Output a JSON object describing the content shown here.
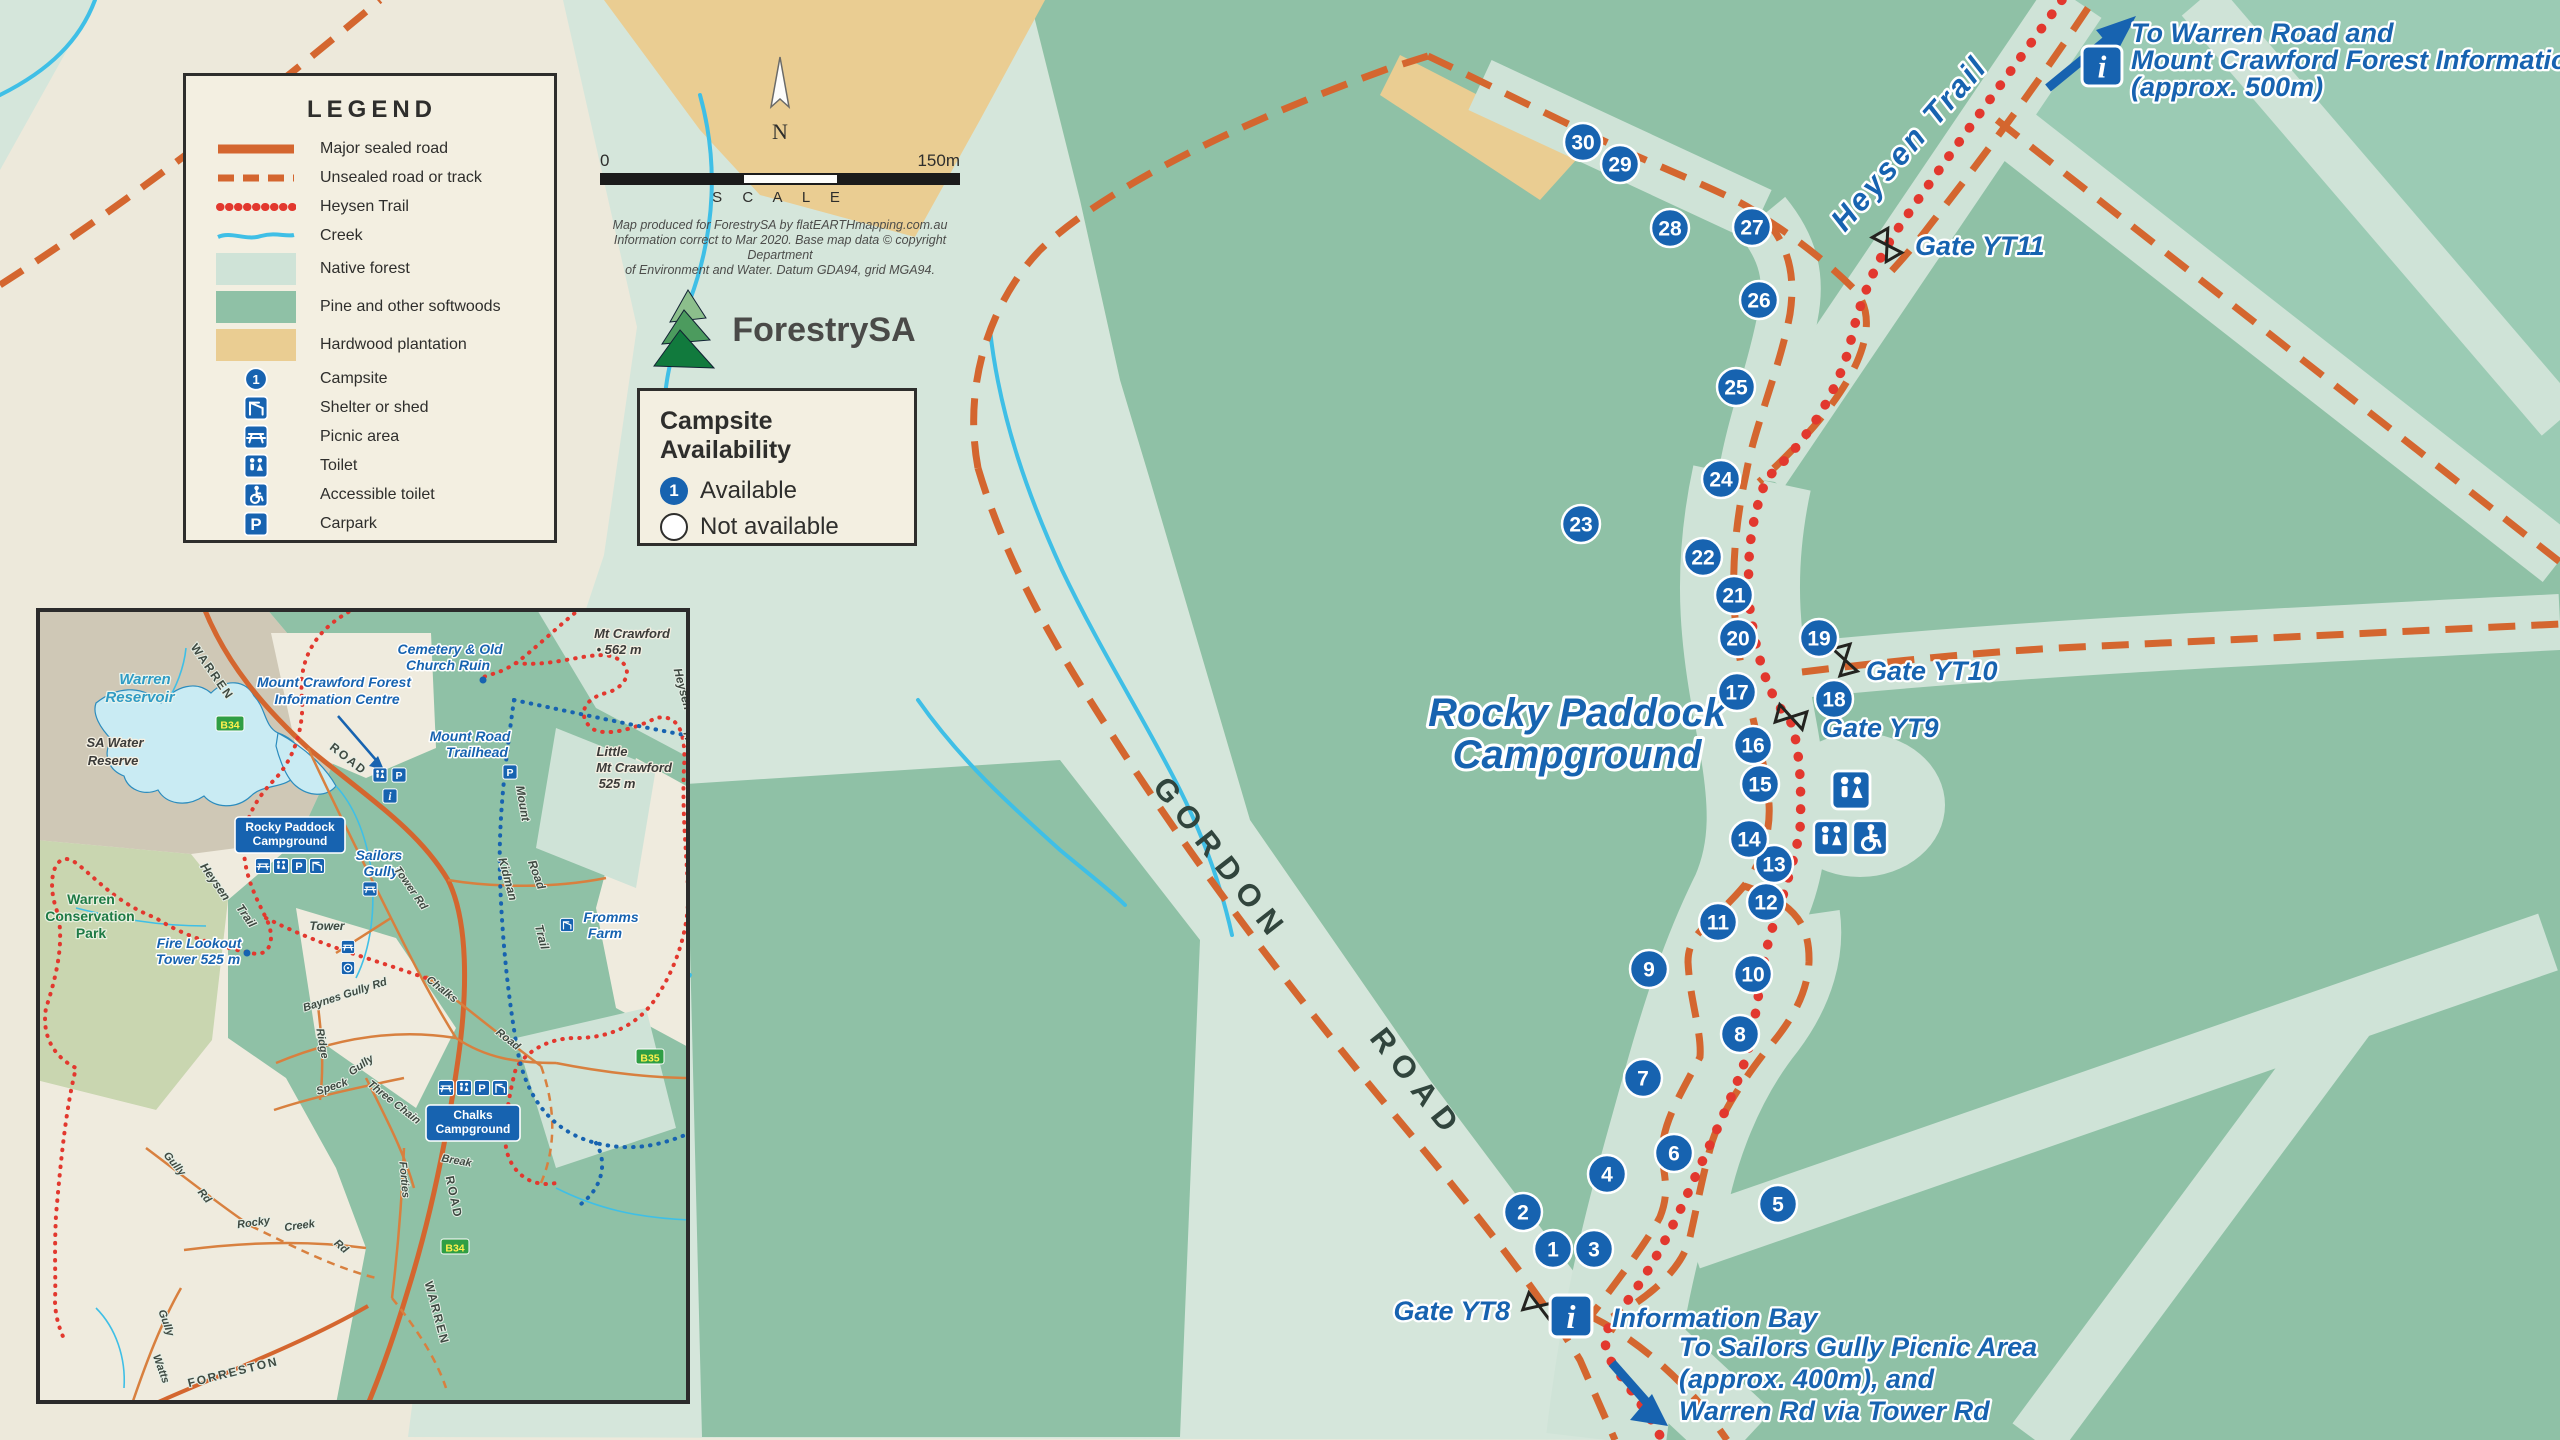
{
  "legend": {
    "title": "LEGEND",
    "line_items": [
      {
        "key": "road-solid",
        "label": "Major sealed road"
      },
      {
        "key": "road-dashed",
        "label": "Unsealed road or track"
      },
      {
        "key": "trail-dots",
        "label": "Heysen Trail"
      },
      {
        "key": "creek",
        "label": "Creek"
      }
    ],
    "area_items": [
      {
        "key": "native",
        "label": "Native forest",
        "color": "#CFE3D7"
      },
      {
        "key": "pine",
        "label": "Pine and other softwoods",
        "color": "#8FC1A6"
      },
      {
        "key": "hardwood",
        "label": "Hardwood plantation",
        "color": "#EACD92"
      }
    ],
    "icon_items": [
      {
        "key": "campsite",
        "label": "Campsite"
      },
      {
        "key": "shelter",
        "label": "Shelter or shed"
      },
      {
        "key": "picnic",
        "label": "Picnic area"
      },
      {
        "key": "toilet",
        "label": "Toilet"
      },
      {
        "key": "accessible",
        "label": "Accessible toilet"
      },
      {
        "key": "carpark",
        "label": "Carpark"
      }
    ]
  },
  "scalebar": {
    "start": "0",
    "end": "150m",
    "label": "S C A L E",
    "north": "N"
  },
  "credits": [
    "Map produced for ForestrySA by flatEARTHmapping.com.au",
    "Information correct to Mar 2020. Base map data © copyright Department",
    "of Environment and Water. Datum GDA94, grid MGA94."
  ],
  "logo": {
    "name": "ForestrySA"
  },
  "availability": {
    "title": "Campsite Availability",
    "available_number": "1",
    "available_label": "Available",
    "not_available_label": "Not available"
  },
  "colors": {
    "accent_blue": "#1763B0",
    "road_orange": "#D4662F",
    "trail_red": "#E2382E",
    "creek_blue": "#3FBFE6",
    "cream": "#EDE9DB",
    "pale_green": "#CFE3D7",
    "medium_green": "#8FC1A6",
    "hardwood_tan": "#EACD92"
  },
  "map": {
    "campsites": [
      {
        "n": "1",
        "x": 1553,
        "y": 1249
      },
      {
        "n": "2",
        "x": 1523,
        "y": 1212
      },
      {
        "n": "3",
        "x": 1594,
        "y": 1249
      },
      {
        "n": "4",
        "x": 1607,
        "y": 1174
      },
      {
        "n": "5",
        "x": 1778,
        "y": 1204
      },
      {
        "n": "6",
        "x": 1674,
        "y": 1153
      },
      {
        "n": "7",
        "x": 1643,
        "y": 1078
      },
      {
        "n": "8",
        "x": 1740,
        "y": 1034
      },
      {
        "n": "9",
        "x": 1649,
        "y": 969
      },
      {
        "n": "10",
        "x": 1753,
        "y": 974
      },
      {
        "n": "11",
        "x": 1718,
        "y": 922
      },
      {
        "n": "12",
        "x": 1766,
        "y": 902
      },
      {
        "n": "13",
        "x": 1774,
        "y": 864
      },
      {
        "n": "14",
        "x": 1749,
        "y": 839
      },
      {
        "n": "15",
        "x": 1760,
        "y": 784
      },
      {
        "n": "16",
        "x": 1753,
        "y": 745
      },
      {
        "n": "17",
        "x": 1737,
        "y": 692
      },
      {
        "n": "18",
        "x": 1834,
        "y": 699
      },
      {
        "n": "19",
        "x": 1819,
        "y": 638
      },
      {
        "n": "20",
        "x": 1738,
        "y": 638
      },
      {
        "n": "21",
        "x": 1734,
        "y": 595
      },
      {
        "n": "22",
        "x": 1703,
        "y": 557
      },
      {
        "n": "23",
        "x": 1581,
        "y": 524
      },
      {
        "n": "24",
        "x": 1721,
        "y": 479
      },
      {
        "n": "25",
        "x": 1736,
        "y": 387
      },
      {
        "n": "26",
        "x": 1759,
        "y": 300
      },
      {
        "n": "27",
        "x": 1752,
        "y": 227
      },
      {
        "n": "28",
        "x": 1670,
        "y": 228
      },
      {
        "n": "29",
        "x": 1620,
        "y": 164
      },
      {
        "n": "30",
        "x": 1583,
        "y": 142
      }
    ],
    "gates": [
      {
        "x": 1539,
        "y": 1306,
        "r": 20
      },
      {
        "x": 1791,
        "y": 717,
        "r": 15
      },
      {
        "x": 1845,
        "y": 660,
        "r": 75
      },
      {
        "x": 1887,
        "y": 245,
        "r": 60
      }
    ],
    "facilities": [
      {
        "t": "toilet",
        "x": 1851,
        "y": 790,
        "s": 40
      },
      {
        "t": "toilet",
        "x": 1831,
        "y": 838,
        "s": 36
      },
      {
        "t": "accessible",
        "x": 1870,
        "y": 838,
        "s": 36
      },
      {
        "t": "info",
        "x": 1571,
        "y": 1316,
        "s": 44
      },
      {
        "t": "info",
        "x": 2102,
        "y": 66,
        "s": 42
      }
    ],
    "labels": [
      {
        "t": "Rocky Paddock",
        "x": 1577,
        "y": 726,
        "r": 0,
        "c": "t-big"
      },
      {
        "t": "Campground",
        "x": 1577,
        "y": 768,
        "r": 0,
        "c": "t-big"
      },
      {
        "t": "Heysen  Trail",
        "x": 1917,
        "y": 150,
        "r": -49,
        "c": "t-trail"
      },
      {
        "t": "GORDON",
        "x": 1213,
        "y": 866,
        "r": 52,
        "c": "t-road"
      },
      {
        "t": "ROAD",
        "x": 1409,
        "y": 1090,
        "r": 52,
        "c": "t-road"
      },
      {
        "t": "Gate YT8",
        "x": 1510,
        "y": 1320,
        "r": 0,
        "c": "t-gate t-gate-end"
      },
      {
        "t": "Gate YT9",
        "x": 1822,
        "y": 737,
        "r": 0,
        "c": "t-gate"
      },
      {
        "t": "Gate YT10",
        "x": 1866,
        "y": 680,
        "r": 0,
        "c": "t-gate"
      },
      {
        "t": "Gate YT11",
        "x": 1915,
        "y": 255,
        "r": 0,
        "c": "t-gate"
      },
      {
        "t": "Information Bay",
        "x": 1612,
        "y": 1327,
        "r": 0,
        "c": "t-gate"
      },
      {
        "t": "To Warren Road and",
        "x": 2131,
        "y": 42,
        "r": 0,
        "c": "t-note"
      },
      {
        "t": "Mount Crawford Forest Information Centre",
        "x": 2131,
        "y": 69,
        "r": 0,
        "c": "t-note"
      },
      {
        "t": "(approx. 500m)",
        "x": 2131,
        "y": 96,
        "r": 0,
        "c": "t-note"
      },
      {
        "t": "To Sailors Gully Picnic Area",
        "x": 1679,
        "y": 1356,
        "r": 0,
        "c": "t-note"
      },
      {
        "t": "(approx. 400m), and",
        "x": 1679,
        "y": 1388,
        "r": 0,
        "c": "t-note"
      },
      {
        "t": "Warren Rd via Tower Rd",
        "x": 1679,
        "y": 1420,
        "r": 0,
        "c": "t-note"
      }
    ]
  },
  "inset": {
    "labels": [
      {
        "t": "Warren",
        "x": 109,
        "y": 76,
        "r": 0,
        "c": "i-water"
      },
      {
        "t": "Reservoir",
        "x": 104,
        "y": 94,
        "r": 0,
        "c": "i-water"
      },
      {
        "t": "WARREN",
        "x": 173,
        "y": 66,
        "r": 55,
        "c": "i-caps"
      },
      {
        "t": "ROAD",
        "x": 310,
        "y": 154,
        "r": 38,
        "c": "i-caps"
      },
      {
        "t": "SA Water",
        "x": 79,
        "y": 139,
        "r": 0,
        "c": "i-dark"
      },
      {
        "t": "Reserve",
        "x": 77,
        "y": 157,
        "r": 0,
        "c": "i-dark"
      },
      {
        "t": "Mount Crawford Forest",
        "x": 298,
        "y": 79,
        "r": 0,
        "c": "i-blue"
      },
      {
        "t": "Information Centre",
        "x": 301,
        "y": 96,
        "r": 0,
        "c": "i-blue"
      },
      {
        "t": "Cemetery & Old",
        "x": 414,
        "y": 46,
        "r": 0,
        "c": "i-blue"
      },
      {
        "t": "Church Ruin",
        "x": 412,
        "y": 62,
        "r": 0,
        "c": "i-blue"
      },
      {
        "t": "Mt Crawford",
        "x": 596,
        "y": 30,
        "r": 0,
        "c": "i-dark"
      },
      {
        "t": "• 562 m",
        "x": 583,
        "y": 46,
        "r": 0,
        "c": "i-dark"
      },
      {
        "t": "Mount Road",
        "x": 434,
        "y": 133,
        "r": 0,
        "c": "i-blue"
      },
      {
        "t": "Trailhead",
        "x": 441,
        "y": 149,
        "r": 0,
        "c": "i-blue"
      },
      {
        "t": "Little",
        "x": 576,
        "y": 148,
        "r": 0,
        "c": "i-dark"
      },
      {
        "t": "Mt Crawford",
        "x": 598,
        "y": 164,
        "r": 0,
        "c": "i-dark"
      },
      {
        "t": "525 m",
        "x": 581,
        "y": 180,
        "r": 0,
        "c": "i-dark"
      },
      {
        "t": "Mount",
        "x": 483,
        "y": 196,
        "r": 80,
        "c": "i-road"
      },
      {
        "t": "Road",
        "x": 497,
        "y": 268,
        "r": 70,
        "c": "i-road"
      },
      {
        "t": "Kidman",
        "x": 468,
        "y": 272,
        "r": 75,
        "c": "i-road"
      },
      {
        "t": "Trail",
        "x": 502,
        "y": 330,
        "r": 75,
        "c": "i-road"
      },
      {
        "t": "Heysen",
        "x": 643,
        "y": 82,
        "r": 75,
        "c": "i-road"
      },
      {
        "t": "Trail",
        "x": 650,
        "y": 135,
        "r": 75,
        "c": "i-road"
      },
      {
        "t": "Heysen",
        "x": 176,
        "y": 276,
        "r": 55,
        "c": "i-road"
      },
      {
        "t": "Trail",
        "x": 207,
        "y": 310,
        "r": 55,
        "c": "i-road"
      },
      {
        "t": "Sailors",
        "x": 343,
        "y": 252,
        "r": 0,
        "c": "i-blue"
      },
      {
        "t": "Gully",
        "x": 345,
        "y": 268,
        "r": 0,
        "c": "i-blue"
      },
      {
        "t": "Tower Rd",
        "x": 372,
        "y": 282,
        "r": 55,
        "c": "i-road-sm"
      },
      {
        "t": "Tower",
        "x": 291,
        "y": 322,
        "r": 0,
        "c": "i-road"
      },
      {
        "t": "Fire Lookout",
        "x": 163,
        "y": 340,
        "r": 0,
        "c": "i-blue"
      },
      {
        "t": "Tower 525 m",
        "x": 162,
        "y": 356,
        "r": 0,
        "c": "i-blue"
      },
      {
        "t": "Warren",
        "x": 55,
        "y": 296,
        "r": 0,
        "c": "i-green"
      },
      {
        "t": "Conservation",
        "x": 54,
        "y": 313,
        "r": 0,
        "c": "i-green"
      },
      {
        "t": "Park",
        "x": 55,
        "y": 330,
        "r": 0,
        "c": "i-green"
      },
      {
        "t": "Fromms",
        "x": 575,
        "y": 314,
        "r": 0,
        "c": "i-blue"
      },
      {
        "t": "Farm",
        "x": 569,
        "y": 330,
        "r": 0,
        "c": "i-blue"
      },
      {
        "t": "Baynes Gully Rd",
        "x": 310,
        "y": 390,
        "r": -18,
        "c": "i-road-sm"
      },
      {
        "t": "Ridge",
        "x": 283,
        "y": 436,
        "r": 80,
        "c": "i-road-sm"
      },
      {
        "t": "Gully",
        "x": 327,
        "y": 460,
        "r": -35,
        "c": "i-road-sm"
      },
      {
        "t": "Speck",
        "x": 297,
        "y": 482,
        "r": -18,
        "c": "i-road-sm"
      },
      {
        "t": "Three Chain",
        "x": 356,
        "y": 497,
        "r": 38,
        "c": "i-road-sm"
      },
      {
        "t": "Chalks",
        "x": 404,
        "y": 384,
        "r": 38,
        "c": "i-road-sm"
      },
      {
        "t": "Road",
        "x": 470,
        "y": 434,
        "r": 38,
        "c": "i-road-sm"
      },
      {
        "t": "Break",
        "x": 420,
        "y": 556,
        "r": 10,
        "c": "i-road-sm"
      },
      {
        "t": "Forties",
        "x": 365,
        "y": 572,
        "r": 85,
        "c": "i-road-sm"
      },
      {
        "t": "Gully",
        "x": 136,
        "y": 558,
        "r": 50,
        "c": "i-road-sm"
      },
      {
        "t": "Rd",
        "x": 166,
        "y": 590,
        "r": 50,
        "c": "i-road-sm"
      },
      {
        "t": "Rocky",
        "x": 218,
        "y": 618,
        "r": -8,
        "c": "i-road-sm"
      },
      {
        "t": "Creek",
        "x": 264,
        "y": 621,
        "r": -8,
        "c": "i-road-sm"
      },
      {
        "t": "Rd",
        "x": 303,
        "y": 641,
        "r": 40,
        "c": "i-road-sm"
      },
      {
        "t": "Gully",
        "x": 127,
        "y": 716,
        "r": 70,
        "c": "i-road-sm"
      },
      {
        "t": "Watts",
        "x": 122,
        "y": 762,
        "r": 70,
        "c": "i-road-sm"
      },
      {
        "t": "FORRESTON",
        "x": 198,
        "y": 768,
        "r": -14,
        "c": "i-caps"
      },
      {
        "t": "WARREN",
        "x": 397,
        "y": 706,
        "r": 75,
        "c": "i-caps"
      },
      {
        "t": "ROAD",
        "x": 414,
        "y": 590,
        "r": 78,
        "c": "i-caps"
      }
    ],
    "badges": [
      {
        "text": "B34",
        "x": 194,
        "y": 117
      },
      {
        "text": "B35",
        "x": 614,
        "y": 450
      },
      {
        "text": "B34",
        "x": 419,
        "y": 640
      }
    ],
    "campground_boxes": [
      {
        "lines": [
          "Rocky Paddock",
          "Campground"
        ],
        "x": 254,
        "y": 211,
        "w": 110,
        "icons": [
          "picnic",
          "toilet",
          "carpark",
          "shelter"
        ],
        "icons_y": 258
      },
      {
        "lines": [
          "Chalks",
          "Campground"
        ],
        "x": 437,
        "y": 499,
        "w": 94,
        "icons": [
          "picnic",
          "toilet",
          "carpark",
          "shelter"
        ],
        "icons_y": 480
      }
    ],
    "poi_icons": [
      {
        "t": "picnic",
        "x": 334,
        "y": 281,
        "s": 15
      },
      {
        "t": "picnic",
        "x": 312,
        "y": 339,
        "s": 14
      },
      {
        "t": "lookout",
        "x": 312,
        "y": 360,
        "s": 14
      },
      {
        "t": "toilet",
        "x": 344,
        "y": 167,
        "s": 15
      },
      {
        "t": "carpark",
        "x": 363,
        "y": 167,
        "s": 15
      },
      {
        "t": "info",
        "x": 354,
        "y": 188,
        "s": 15
      },
      {
        "t": "carpark",
        "x": 474,
        "y": 164,
        "s": 15
      },
      {
        "t": "shelter",
        "x": 531,
        "y": 317,
        "s": 14
      }
    ]
  }
}
